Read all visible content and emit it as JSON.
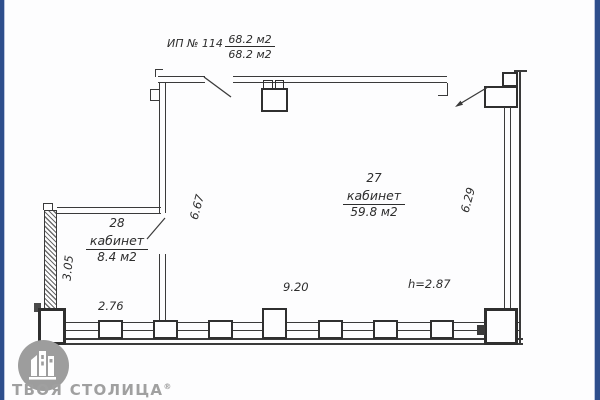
{
  "scan": {
    "border_color": "#2e4e8c",
    "ink_color": "#3a3a3a",
    "watermark_color": "#9d9d9d"
  },
  "title_block": {
    "unit_label": "ИП № 114",
    "area_numerator": "68.2 м2",
    "area_denominator": "68.2 м2"
  },
  "rooms": [
    {
      "number": "27",
      "name": "кабинет",
      "area": "59.8 м2"
    },
    {
      "number": "28",
      "name": "кабинет",
      "area": "8.4 м2"
    }
  ],
  "dimensions": {
    "left_depth": "6.67",
    "right_depth": "6.29",
    "room28_depth": "3.05",
    "room28_width": "2.76",
    "room27_width": "9.20",
    "ceiling_height": "h=2.87"
  },
  "watermark": {
    "brand": "ТВОЯ СТОЛИЦА",
    "registered": "®"
  }
}
